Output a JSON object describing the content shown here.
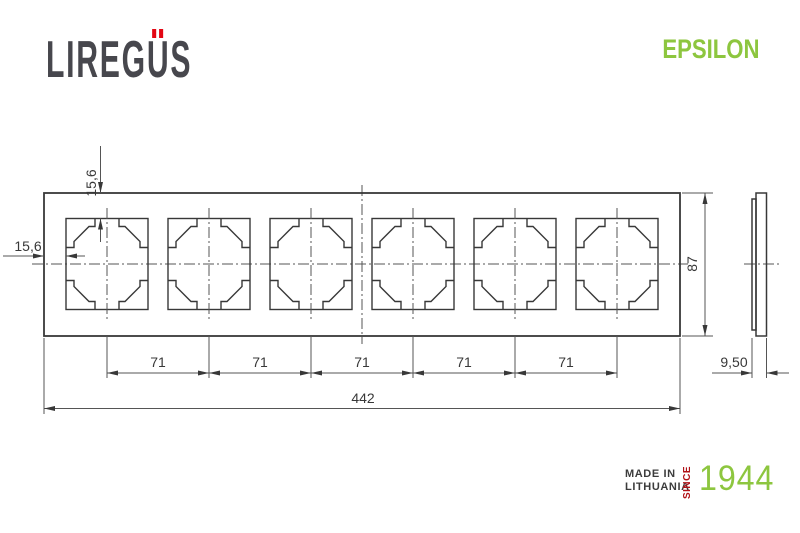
{
  "brand": {
    "name": "LIREGUS",
    "prefix": "LIREG",
    "umlaut_letter": "U",
    "suffix": "S"
  },
  "series": {
    "name": "EPSILON"
  },
  "origin": {
    "line1": "MADE IN",
    "line2": "LITHUANIA",
    "since_label": "SINCE",
    "year": "1944"
  },
  "drawing": {
    "type": "technical-dimension-drawing",
    "views": {
      "front": "6-gang frame front view",
      "side": "frame side profile view"
    },
    "dimensions": {
      "top_inset": "15,6",
      "left_inset": "15,6",
      "pitch_labels": [
        "71",
        "71",
        "71",
        "71",
        "71"
      ],
      "total_width": "442",
      "height": "87",
      "depth": "9,50"
    }
  },
  "colors": {
    "ink": "#383838",
    "dimension_line": "#555555",
    "brand_gray": "#47474d",
    "accent_red": "#e30613",
    "since_red": "#b11217",
    "accent_green": "#8dc63f"
  }
}
